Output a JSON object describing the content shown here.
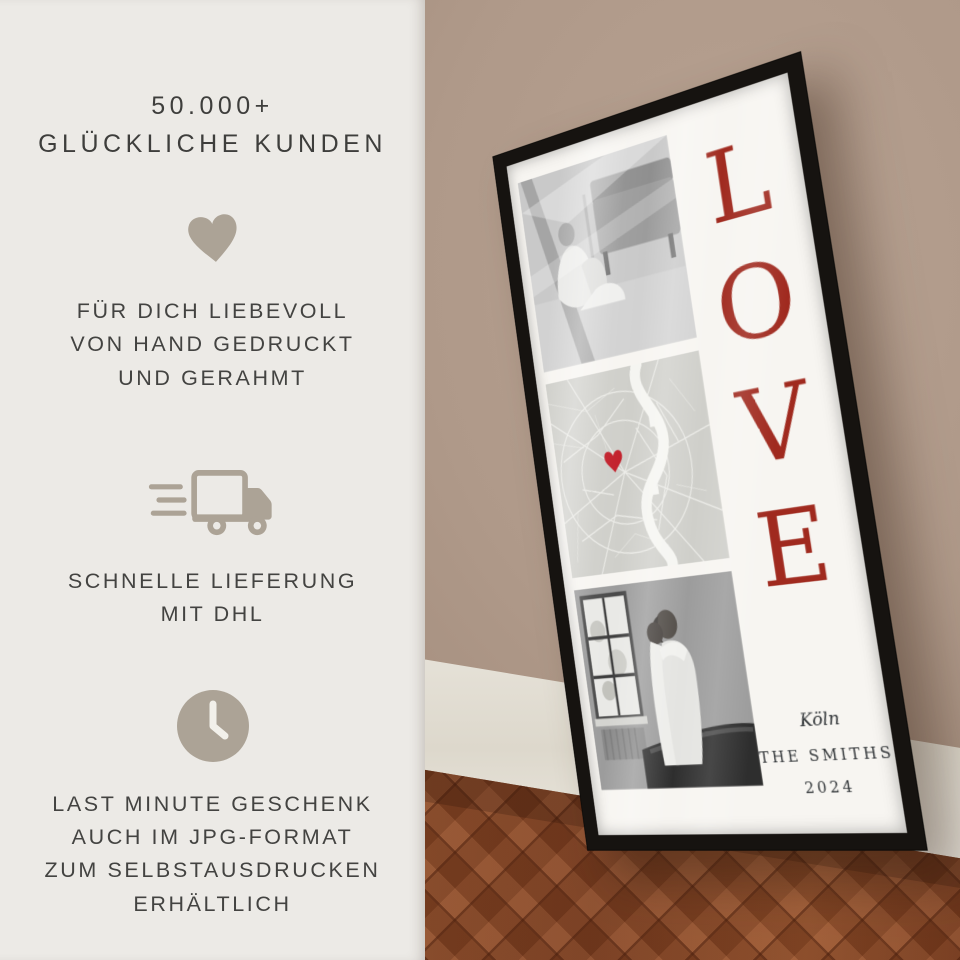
{
  "panel": {
    "heading_line1": "50.000+",
    "heading_line2": "GLÜCKLICHE KUNDEN",
    "features": [
      {
        "icon": "heart-icon",
        "lines": [
          "FÜR DICH LIEBEVOLL",
          "VON HAND GEDRUCKT",
          "UND GERAHMT"
        ]
      },
      {
        "icon": "delivery-truck-icon",
        "lines": [
          "SCHNELLE LIEFERUNG",
          "MIT DHL"
        ]
      },
      {
        "icon": "clock-icon",
        "lines": [
          "LAST MINUTE GESCHENK",
          "AUCH IM JPG-FORMAT",
          "ZUM SELBSTAUSDRUCKEN",
          "ERHÄLTLICH"
        ]
      }
    ]
  },
  "poster": {
    "word_vertical": [
      "L",
      "O",
      "V",
      "E"
    ],
    "city": "Köln",
    "family_name": "THE SMITHS",
    "year": "2024",
    "map_marker": "heart-marker-icon",
    "photos": [
      "couple-sitting-livingroom-bw",
      "city-map-koeln",
      "couple-embracing-window-bw"
    ]
  },
  "colors": {
    "panel_background": "#ECEAE6",
    "panel_text": "#3E3E3C",
    "panel_icon_taupe": "#ACA396",
    "love_red": "#A02A1F",
    "heart_marker_red": "#C2202B",
    "frame_black": "#161310",
    "wall_tan": "#AF9989",
    "baseboard_white": "#EFECE4",
    "floor_brown": "#854525",
    "poster_white": "#F7F5F1",
    "map_gray": "#CFCFCA"
  }
}
